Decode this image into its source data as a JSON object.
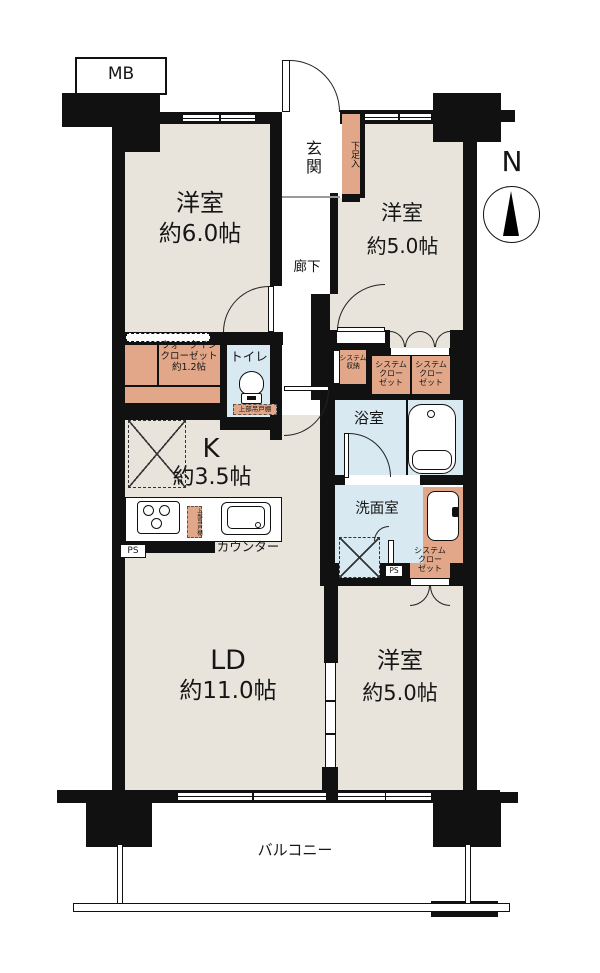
{
  "colors": {
    "wall": "#111111",
    "floor": "#e8e4dc",
    "closet": "#e2a788",
    "wet_area": "#d8e9f2"
  },
  "compass": {
    "north": "N"
  },
  "meter_box": {
    "label": "MB"
  },
  "entrance": {
    "label": "玄関",
    "shoe_cabinet": "下足入"
  },
  "hallway": {
    "label": "廊下"
  },
  "rooms": {
    "bedroom_nw": {
      "name": "洋室",
      "size": "約6.0帖"
    },
    "bedroom_ne": {
      "name": "洋室",
      "size": "約5.0帖"
    },
    "bedroom_s": {
      "name": "洋室",
      "size": "約5.0帖"
    },
    "living": {
      "name": "LD",
      "size": "約11.0帖"
    },
    "kitchen": {
      "name": "K",
      "size": "約3.5帖",
      "counter": "カウンター",
      "hanging_shelf": "上部吊戸棚"
    },
    "bathroom": {
      "name": "浴室"
    },
    "washroom": {
      "name": "洗面室"
    },
    "toilet": {
      "name": "トイレ",
      "hanging_shelf": "上部吊戸棚"
    }
  },
  "storage": {
    "wic": "ウォークイン\nクローゼット\n約1.2帖",
    "system_storage": "システム\n収納",
    "system_closet": "システム\nクロー\nゼット"
  },
  "labels": {
    "balcony": "バルコニー",
    "ps": "PS"
  }
}
